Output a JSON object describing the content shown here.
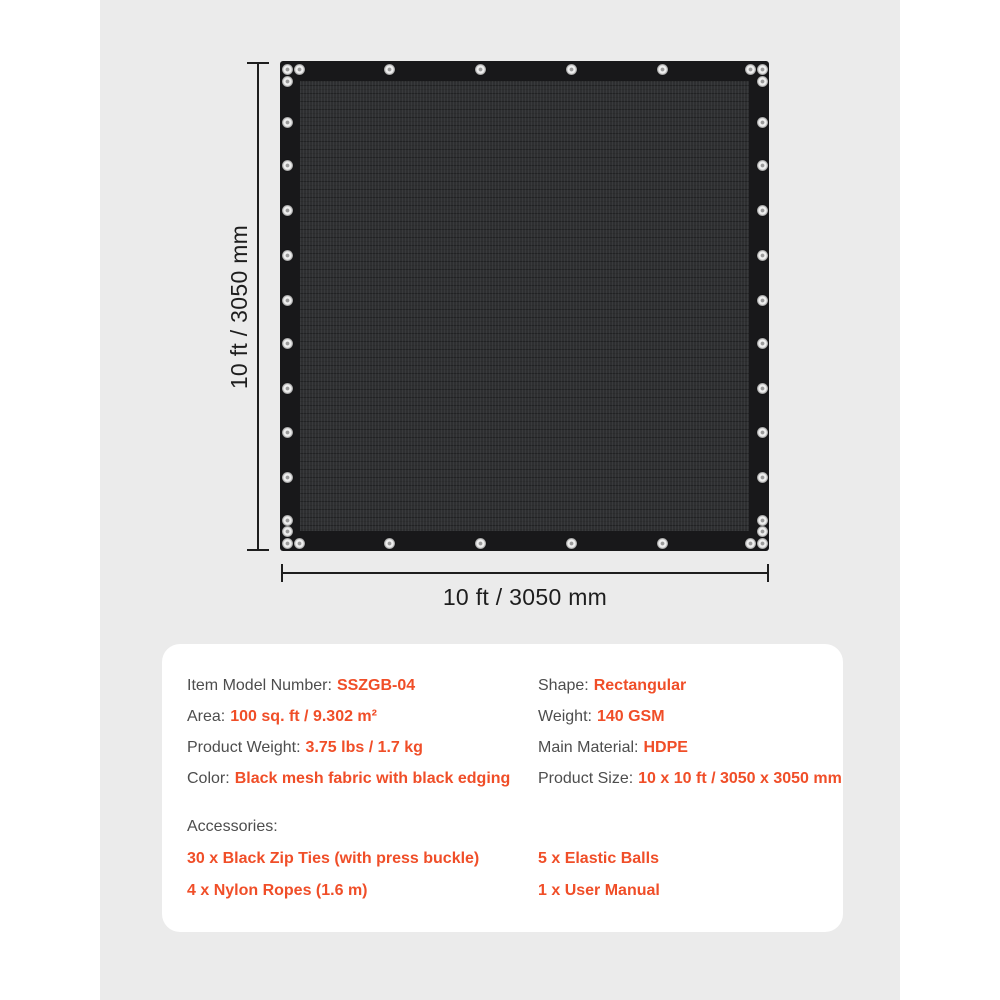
{
  "page": {
    "background_color": "#ffffff",
    "panel_color": "#ebebeb",
    "accent_color": "#f04e28",
    "label_color": "#4d4d4d",
    "dimension_line_color": "#1e1e1e",
    "tarp_edging_color": "#18181a",
    "tarp_mesh_color": "#2e2f31",
    "grommet_color": "#e8e8e8"
  },
  "diagram": {
    "height_label": "10 ft / 3050 mm",
    "width_label": "10 ft / 3050 mm",
    "fabric_description": "Black mesh fabric with black edging",
    "grommet_icon": "grommet"
  },
  "card": {
    "specs_left": [
      {
        "label": "Item Model Number:",
        "value": "SSZGB-04"
      },
      {
        "label": "Area:",
        "value": "100 sq. ft / 9.302 m²"
      },
      {
        "label": "Product Weight:",
        "value": "3.75 lbs / 1.7 kg"
      },
      {
        "label": "Color:",
        "value": "Black mesh fabric with black edging"
      }
    ],
    "specs_right": [
      {
        "label": "Shape:",
        "value": "Rectangular"
      },
      {
        "label": "Weight:",
        "value": "140 GSM"
      },
      {
        "label": "Main Material:",
        "value": "HDPE"
      },
      {
        "label": "Product Size:",
        "value": "10 x 10 ft / 3050 x 3050 mm"
      }
    ],
    "accessories": {
      "title": "Accessories:",
      "items_left": [
        "30 x Black Zip Ties (with press buckle)",
        "4 x Nylon Ropes (1.6 m)"
      ],
      "items_right": [
        "5 x Elastic Balls",
        "1 x User Manual"
      ]
    }
  }
}
